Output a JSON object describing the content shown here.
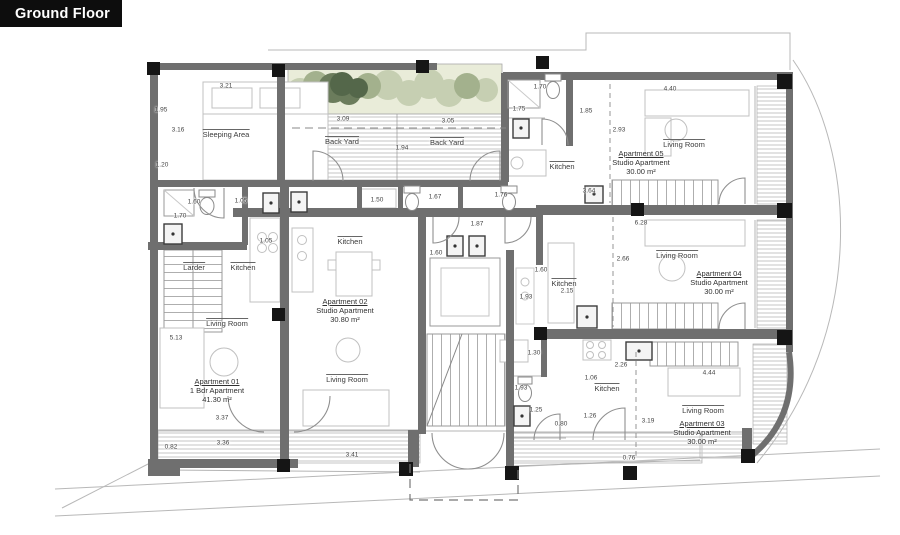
{
  "title": "Ground Floor",
  "plan": {
    "apartments": [
      {
        "name": "Apartment 01",
        "type": "1 Bdr Apartment",
        "area": "41.30 m²",
        "x": 217,
        "y": 382
      },
      {
        "name": "Apartment 02",
        "type": "Studio Apartment",
        "area": "30.80 m²",
        "x": 345,
        "y": 302
      },
      {
        "name": "Apartment 03",
        "type": "Studio Apartment",
        "area": "30.00 m²",
        "x": 702,
        "y": 424
      },
      {
        "name": "Apartment 04",
        "type": "Studio Apartment",
        "area": "30.00 m²",
        "x": 719,
        "y": 274
      },
      {
        "name": "Apartment 05",
        "type": "Studio Apartment",
        "area": "30.00 m²",
        "x": 641,
        "y": 154
      }
    ],
    "rooms": [
      {
        "label": "Sleeping Area",
        "x": 226,
        "y": 134
      },
      {
        "label": "Back Yard",
        "x": 342,
        "y": 141
      },
      {
        "label": "Back Yard",
        "x": 447,
        "y": 142
      },
      {
        "label": "Kitchen",
        "x": 562,
        "y": 166
      },
      {
        "label": "Living Room",
        "x": 684,
        "y": 144
      },
      {
        "label": "Larder",
        "x": 194,
        "y": 267
      },
      {
        "label": "Kitchen",
        "x": 243,
        "y": 267
      },
      {
        "label": "Kitchen",
        "x": 350,
        "y": 241
      },
      {
        "label": "Kitchen",
        "x": 564,
        "y": 283
      },
      {
        "label": "Living Room",
        "x": 677,
        "y": 255
      },
      {
        "label": "Living Room",
        "x": 227,
        "y": 323
      },
      {
        "label": "Living Room",
        "x": 347,
        "y": 379
      },
      {
        "label": "Kitchen",
        "x": 607,
        "y": 388
      },
      {
        "label": "Living Room",
        "x": 703,
        "y": 410
      }
    ],
    "dimensions": [
      {
        "v": "3.21",
        "x": 226,
        "y": 86
      },
      {
        "v": "1.95",
        "x": 161,
        "y": 110
      },
      {
        "v": "3.16",
        "x": 178,
        "y": 130
      },
      {
        "v": "1.20",
        "x": 162,
        "y": 165
      },
      {
        "v": "1.60",
        "x": 194,
        "y": 202
      },
      {
        "v": "1.70",
        "x": 180,
        "y": 216
      },
      {
        "v": "1.05",
        "x": 241,
        "y": 201
      },
      {
        "v": "3.09",
        "x": 343,
        "y": 119
      },
      {
        "v": "3.05",
        "x": 448,
        "y": 121
      },
      {
        "v": "1.94",
        "x": 402,
        "y": 148
      },
      {
        "v": "1.70",
        "x": 540,
        "y": 87
      },
      {
        "v": "1.75",
        "x": 519,
        "y": 109
      },
      {
        "v": "1.85",
        "x": 586,
        "y": 111
      },
      {
        "v": "2.93",
        "x": 619,
        "y": 130
      },
      {
        "v": "4.40",
        "x": 670,
        "y": 89
      },
      {
        "v": "1.05",
        "x": 266,
        "y": 241
      },
      {
        "v": "1.50",
        "x": 377,
        "y": 200
      },
      {
        "v": "1.67",
        "x": 435,
        "y": 197
      },
      {
        "v": "1.76",
        "x": 501,
        "y": 195
      },
      {
        "v": "1.87",
        "x": 477,
        "y": 224
      },
      {
        "v": "1.60",
        "x": 436,
        "y": 253
      },
      {
        "v": "1.60",
        "x": 541,
        "y": 270
      },
      {
        "v": "1.93",
        "x": 526,
        "y": 297
      },
      {
        "v": "2.15",
        "x": 567,
        "y": 291
      },
      {
        "v": "3.64",
        "x": 589,
        "y": 191
      },
      {
        "v": "6.28",
        "x": 641,
        "y": 223
      },
      {
        "v": "2.66",
        "x": 623,
        "y": 259
      },
      {
        "v": "5.13",
        "x": 176,
        "y": 338
      },
      {
        "v": "3.37",
        "x": 222,
        "y": 418
      },
      {
        "v": "3.36",
        "x": 223,
        "y": 443
      },
      {
        "v": "0.82",
        "x": 171,
        "y": 447
      },
      {
        "v": "3.41",
        "x": 352,
        "y": 455
      },
      {
        "v": "1.30",
        "x": 534,
        "y": 353
      },
      {
        "v": "1.93",
        "x": 521,
        "y": 388
      },
      {
        "v": "1.25",
        "x": 536,
        "y": 410
      },
      {
        "v": "0.80",
        "x": 561,
        "y": 424
      },
      {
        "v": "1.06",
        "x": 591,
        "y": 378
      },
      {
        "v": "2.26",
        "x": 621,
        "y": 365
      },
      {
        "v": "1.26",
        "x": 590,
        "y": 416
      },
      {
        "v": "3.19",
        "x": 648,
        "y": 421
      },
      {
        "v": "0.76",
        "x": 629,
        "y": 458
      },
      {
        "v": "4.44",
        "x": 709,
        "y": 373
      }
    ],
    "colors": {
      "title_bg": "#0d0d0d",
      "title_fg": "#ffffff",
      "wall": "#6f6f6f",
      "column": "#151515",
      "hatch": "#c6c6c6",
      "greenery_bg": "#e9ecd9",
      "greenery_dark": "#54674a",
      "text": "#3a3a3a"
    }
  }
}
